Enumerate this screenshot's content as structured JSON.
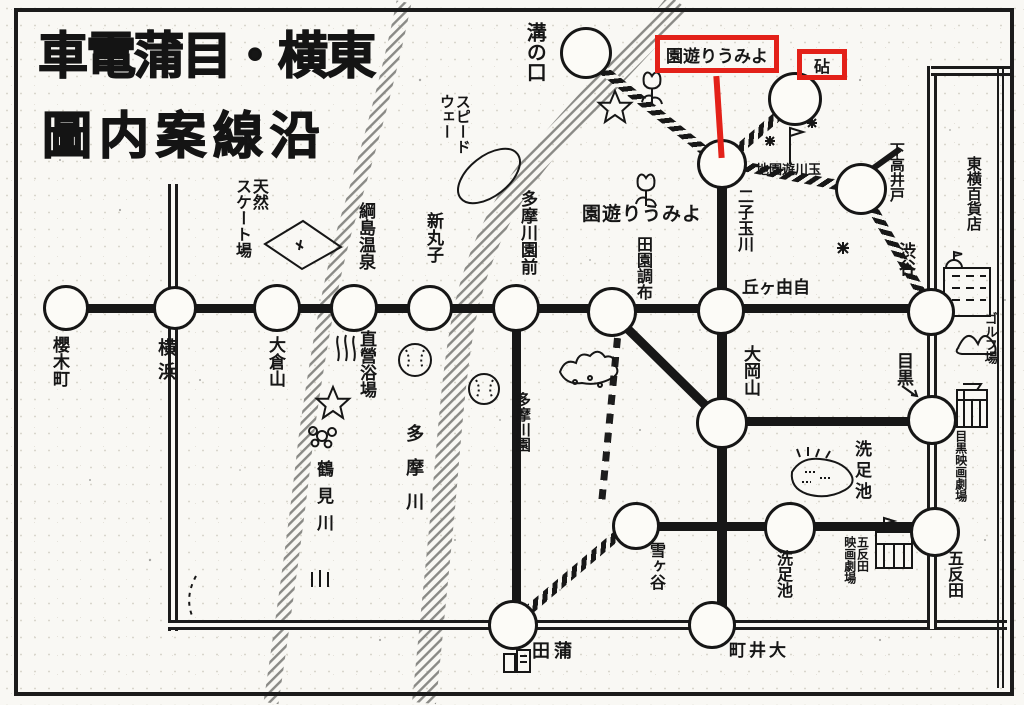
{
  "title": {
    "row1": "車電蒲目・横東",
    "row2": "圖内案線沿"
  },
  "red_annotations": {
    "yomiuri_box_label": "園遊りうみよ",
    "kinuta_box_label": "砧"
  },
  "labels": {
    "mizonokuchi": "溝の口",
    "speedway": "スピード\nウェー",
    "skating_rink": "天然\nスケート場",
    "tsunashima_onsen": "綱島温泉",
    "chokuei_yokujo": "直營浴場",
    "shin_maruko": "新丸子",
    "tamagawaen_mae": "多摩川園前",
    "tamagawaen_park": "多摩川園",
    "denenchofu": "田園調布",
    "yomiuri_yuen_map": "園遊りうみよ",
    "futako_tamagawa": "二子玉川",
    "tamagawa_yuenchi": "地園遊川玉",
    "jiyugaoka": "丘ヶ由自",
    "shimo_takaido": "下高井戸",
    "shibuya": "渋谷",
    "toyoko_dept_store": "東横百貨店",
    "golf_links": "ゴルフ場",
    "meguro": "目黒",
    "ookayama": "大岡山",
    "meguro_theater": "目黒映画劇場",
    "senzoku_pond": "洗足池",
    "senzokuike_station": "洗足池",
    "yukigaya": "雪ヶ谷",
    "gotanda": "五反田",
    "gotanda_theater": "五反田\n映画劇場",
    "oimachi": "町井大",
    "kamata": "田蒲",
    "okurayama": "大倉山",
    "yokohama": "横浜",
    "sakuragicho": "櫻木町",
    "tsurumi_river": "鶴見川",
    "tama_river": "多摩川"
  },
  "colors": {
    "ink": "#161616",
    "paper": "#f9f8f4",
    "annotation_red": "#e32119",
    "river_hatch": "#8a8a86"
  }
}
